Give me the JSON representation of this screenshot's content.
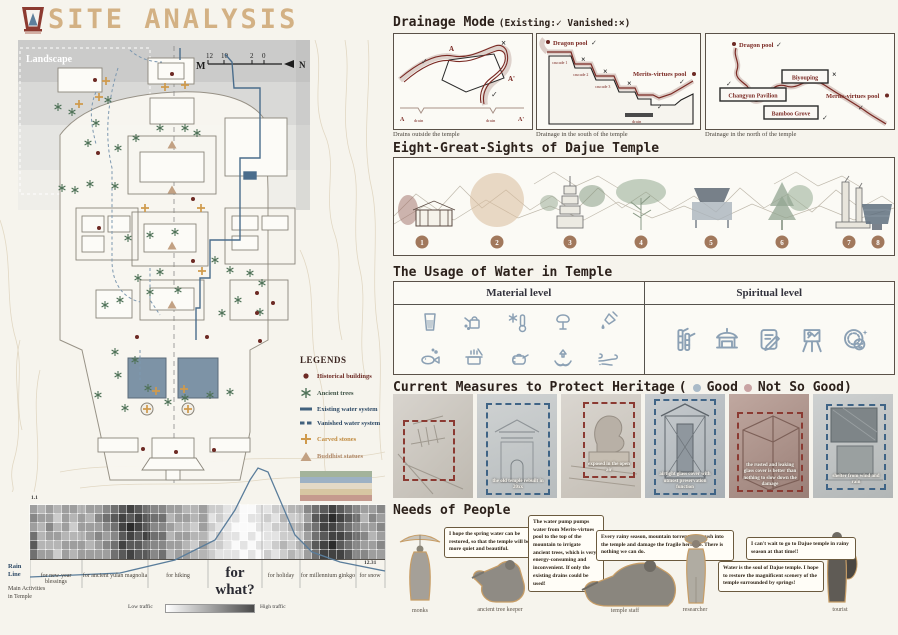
{
  "poster": {
    "title": "SITE ANALYSIS",
    "logo": "pagoda-logo"
  },
  "map": {
    "landscape_label": "Landscape",
    "scale": {
      "m": "M",
      "ticks": [
        "12",
        "10",
        "2",
        "0"
      ],
      "north": "N"
    },
    "legends": {
      "title": "LEGENDS",
      "items": [
        {
          "label": "Historical buildings",
          "symbol": "dot",
          "color": "#6d2a24"
        },
        {
          "label": "Ancient trees",
          "symbol": "asterisk",
          "color": "#4f7258"
        },
        {
          "label": "Existing water system",
          "symbol": "solid-line",
          "color": "#41617d"
        },
        {
          "label": "Vanished water system",
          "symbol": "dashed-line",
          "color": "#41617d"
        },
        {
          "label": "Carved stones",
          "symbol": "cross",
          "color": "#cf9a4c"
        },
        {
          "label": "Buddhist statues",
          "symbol": "triangle",
          "color": "#c2a183"
        }
      ],
      "band_chart_colors": [
        "#a3b39b",
        "#9db1c4",
        "#e3d9c6",
        "#d7c6a2",
        "#c59a8e"
      ]
    }
  },
  "traffic": {
    "rain_line_label": "Rain Line",
    "activities_label": "Main Activities in Temple",
    "start_date": "1.1",
    "end_date": "12.31",
    "columns": [
      "for new-year blessings",
      "for ancient yulan magnolia",
      "for hiking",
      "for what?",
      "for holiday",
      "for millennium ginkgo",
      "for snow"
    ],
    "legend_low": "Low traffic",
    "legend_high": "High traffic"
  },
  "chart_data": {
    "type": "heatmap",
    "title": "Visitor traffic across the year (1.1 - 12.31) with rain line overlay",
    "rows": 6,
    "cols": 44,
    "intensity_scale": "0 = low traffic (white), 9 = high traffic (dark)",
    "intensity_rows": [
      "43434434456787655443342211001122335678765445",
      "54424343567878766344341211011213224789876354",
      "43534244456898755433242110001122335688765445",
      "63443334545787866344331211010112224678876534",
      "73334443456877655443242210101123235789765445",
      "64424344446787756344332111010212324688875544"
    ],
    "column_groups": [
      "for new-year blessings",
      "for ancient yulan magnolia",
      "for hiking",
      "for what?",
      "for holiday",
      "for millennium ginkgo",
      "for snow"
    ],
    "x_range": [
      "1.1",
      "12.31"
    ],
    "rain_line_points": "0,117 90,113 145,100 185,80 205,50 220,20 228,8 238,12 250,40 265,75 282,92 310,102 355,111",
    "legend": {
      "low": "Low traffic",
      "high": "High traffic"
    }
  },
  "drainage": {
    "title": "Drainage Mode",
    "subtitle": "(Existing:✓ Vanished:×)",
    "check": "✓",
    "cross": "×",
    "panel1": {
      "caption": "Drains outside the temple",
      "a": "A",
      "a_prime": "A'",
      "a2": "A",
      "a2_prime": "A'",
      "drain": "drain",
      "drain2": "drain"
    },
    "panel2": {
      "caption": "Drainage in the south of the temple",
      "dragon_pool": "Dragon pool",
      "merits_pool": "Merits-virtues pool",
      "cascade1": "cascade 1",
      "cascade2": "cascade 2",
      "cascade3": "cascade 3",
      "drain": "drain"
    },
    "panel3": {
      "caption": "Drainage in the north of the temple",
      "dragon_pool": "Dragon pool",
      "biyouping": "Biyouping",
      "changyun": "Changyun Pavilion",
      "bamboo": "Bamboo Grove",
      "merits_pool": "Merits-virtues pool"
    }
  },
  "sights": {
    "title": "Eight-Great-Sights of Dajue Temple",
    "numbers": [
      "1",
      "2",
      "3",
      "4",
      "5",
      "6",
      "7",
      "8"
    ],
    "icons": [
      "temple-hall",
      "moon-circle",
      "pagoda",
      "ancient-magnolia",
      "spring-pool",
      "ginkgo-tree",
      "stone-towers",
      "merits-pool"
    ]
  },
  "water_usage": {
    "title": "The Usage of Water in Temple",
    "material_label": "Material level",
    "spiritual_label": "Spiritual level",
    "material_icons": [
      "drinking-glass-icon",
      "watering-can-icon",
      "temperature-snowflake-icon",
      "irrigating-tree-icon",
      "cleaning-dropper-icon",
      "fish-pond-icon",
      "cooking-pot-icon",
      "teapot-icon",
      "offering-hands-icon",
      "wind-icon"
    ],
    "spiritual_icons": [
      "bamboo-icon",
      "temple-pavilion-icon",
      "scripture-scroll-icon",
      "painting-easel-icon",
      "meditation-face-icon"
    ]
  },
  "heritage": {
    "title": "Current Measures to Protect Heritage",
    "legend_prefix": "(",
    "good_label": "Good",
    "bad_label": "Not So Good",
    "legend_suffix": ")",
    "good_color": "#a9bac8",
    "bad_color": "#c9a3a3",
    "photos": [
      {
        "status": "not-so-good",
        "caption": ""
      },
      {
        "status": "good",
        "caption": "the old temple rebuilt in 20xx"
      },
      {
        "status": "not-so-good",
        "caption": "exposed in the open air"
      },
      {
        "status": "good",
        "caption": "airtight glass cover with utmost preservation function"
      },
      {
        "status": "not-so-good",
        "caption": "the rusted and leaking glass cover is better than nothing to slow down the damage"
      },
      {
        "status": "good",
        "caption": "shelter from wind and rain"
      }
    ]
  },
  "needs": {
    "title": "Needs of People",
    "people": [
      {
        "role": "monks",
        "quote": "I hope the spring water can be restored, so that the temple will be more quiet and beautiful."
      },
      {
        "role": "ancient tree keeper",
        "quote": "The water pump pumps water from Merits-virtues pool to the top of the mountain to irrigate ancient trees, which is very energy-consuming and inconvenient. If only the existing drains could be used!"
      },
      {
        "role": "temple staff",
        "quote": "Every rainy season, mountain torrents will rush into the temple and damage the fragile heritage. There is nothing we can do."
      },
      {
        "role": "researcher",
        "quote": "Water is the soul of Dajue temple. I hope to restore the magnificent scenery of the temple surrounded by springs!"
      },
      {
        "role": "tourist",
        "quote": "I can't wait to go to Dajue temple in rainy season at that time!!"
      }
    ]
  }
}
